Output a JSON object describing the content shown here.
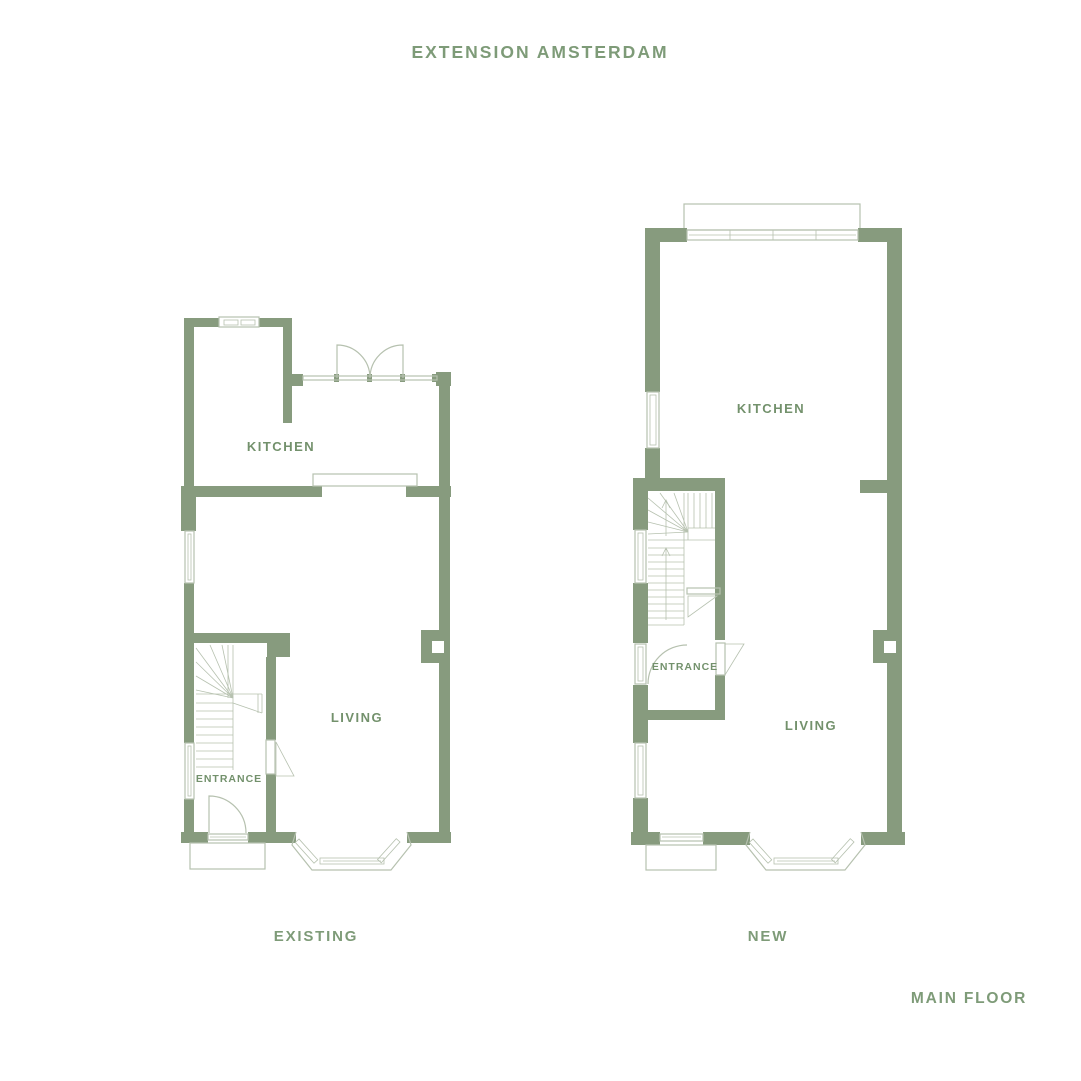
{
  "title": "EXTENSION AMSTERDAM",
  "plans": [
    {
      "name": "EXISTING",
      "rooms": [
        {
          "label": "KITCHEN"
        },
        {
          "label": "LIVING"
        },
        {
          "label": "ENTRANCE"
        }
      ]
    },
    {
      "name": "NEW",
      "rooms": [
        {
          "label": "KITCHEN"
        },
        {
          "label": "ENTRANCE"
        },
        {
          "label": "LIVING"
        }
      ]
    }
  ],
  "footer": {
    "floor_label": "MAIN FLOOR"
  },
  "colors": {
    "wall": "#879b7e",
    "line": "#b6c1af",
    "room_label": "#73916c",
    "heading": "#7e9b78",
    "background": "#ffffff"
  }
}
